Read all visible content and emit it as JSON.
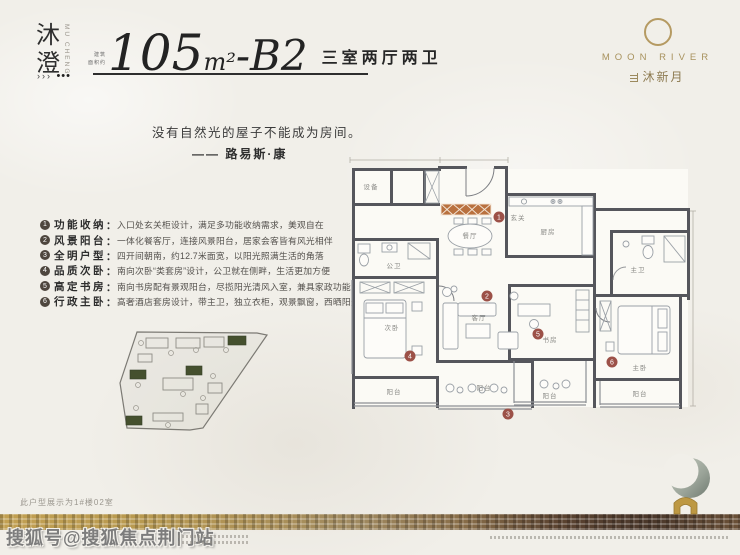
{
  "header": {
    "brand_cn": "沐澄",
    "brand_en": "MU CHENG",
    "marks_chevrons": "›››",
    "marks_dots": "•••",
    "area_prefix_line1": "建筑",
    "area_prefix_line2": "面积约",
    "area_number": "105",
    "area_unit": "m²",
    "unit_suffix": "-B2",
    "rooms_desc": "三室两厅两卫"
  },
  "logo": {
    "en": "MOON RIVER",
    "cn": "沐新月"
  },
  "quote": {
    "text": "没有自然光的屋子不能成为房间。",
    "author": "—— 路易斯·康"
  },
  "punct": {
    "colon": "："
  },
  "features": [
    {
      "num": "1",
      "label": "功能收纳",
      "desc": "入口处玄关柜设计，满足多功能收纳需求，美观自在"
    },
    {
      "num": "2",
      "label": "风景阳台",
      "desc": "一体化餐客厅，连接风景阳台，居家会客皆有风光相伴"
    },
    {
      "num": "3",
      "label": "全明户型",
      "desc": "四开间朝南，约12.7米面宽，以阳光照满生活的角落"
    },
    {
      "num": "4",
      "label": "品质次卧",
      "desc": "南向次卧“类套房”设计，公卫就在侧畔，生活更加方便"
    },
    {
      "num": "5",
      "label": "高定书房",
      "desc": "南向书房配有景观阳台，尽揽阳光清风入室，兼具家政功能"
    },
    {
      "num": "6",
      "label": "行政主卧",
      "desc": "高奢酒店套房设计，带主卫，独立衣柜，观景飘窗，西晒阳光四季映照"
    }
  ],
  "floorplan": {
    "badges": [
      "1",
      "2",
      "3",
      "4",
      "5",
      "6"
    ],
    "rooms": {
      "foyer": "玄关",
      "kitchen": "厨房",
      "dining": "餐厅",
      "living": "客厅",
      "bedroom2": "次卧",
      "bath_guest": "公卫",
      "bath_master": "主卫",
      "study": "书房",
      "master": "主卧",
      "utility": "设备",
      "balcony_b2": "阳台",
      "balcony_living": "阳台",
      "balcony_study": "阳台",
      "balcony_master": "阳台"
    }
  },
  "footer": {
    "unit_note": "此户型展示为1#楼02室",
    "watermark": "搜狐号@搜狐焦点荆门站"
  }
}
